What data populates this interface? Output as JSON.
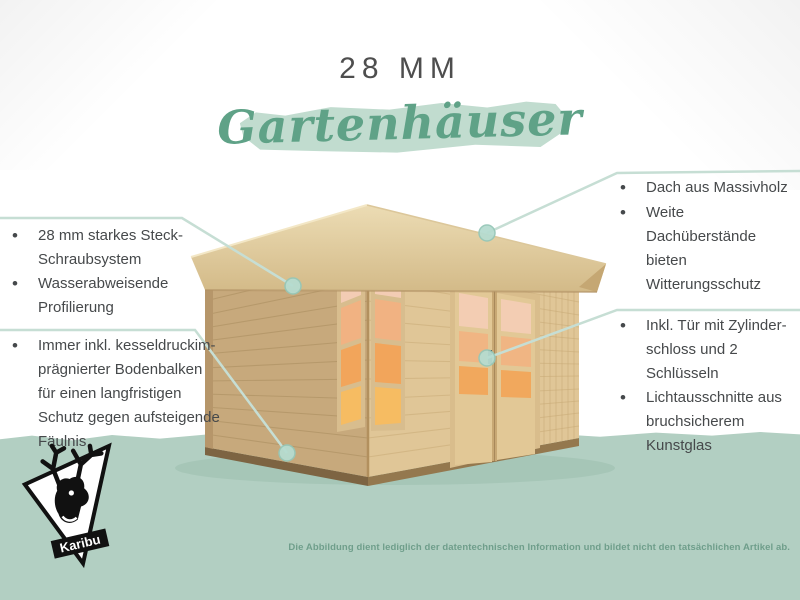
{
  "header": {
    "thickness_label": "28 MM",
    "product_label": "Gartenhäuser"
  },
  "features": {
    "construction": {
      "items": [
        "28 mm starkes Steck-\nSchraubsystem",
        "Wasserabweisende\nProfilierung"
      ]
    },
    "foundation": {
      "items": [
        "Immer inkl. kesseldruckim-\nprägnierter Bodenbalken\nfür einen langfristigen\nSchutz gegen aufsteigende\nFäulnis"
      ]
    },
    "roof": {
      "items": [
        "Dach aus Massivholz",
        "Weite Dachüberstände\nbieten Witterungsschutz"
      ]
    },
    "door": {
      "items": [
        "Inkl. Tür mit Zylinder-\nschloss und 2 Schlüsseln",
        "Lichtausschnitte aus\nbruchsicherem Kunstglas"
      ]
    }
  },
  "footer": {
    "disclaimer": "Die Abbildung dient lediglich der datentechnischen Information und bildet nicht den tatsächlichen Artikel ab."
  },
  "logo": {
    "brand": "Karibu"
  },
  "colors": {
    "ground_band": "#b2cfc2",
    "script_green": "#5fa287",
    "brush_stroke": "#c1dccf",
    "callout_line": "#c6ded4",
    "callout_dot": "#b6dcd0",
    "body_text": "#46494b",
    "disclaimer_text": "#6f9e8b",
    "wood_light": "#e0c697",
    "wood_dark": "#c7a97c",
    "roof_wood": "#e7d6ab",
    "glass_orange": "#f2a85e",
    "clerestory_orange": "#f09a2d"
  }
}
